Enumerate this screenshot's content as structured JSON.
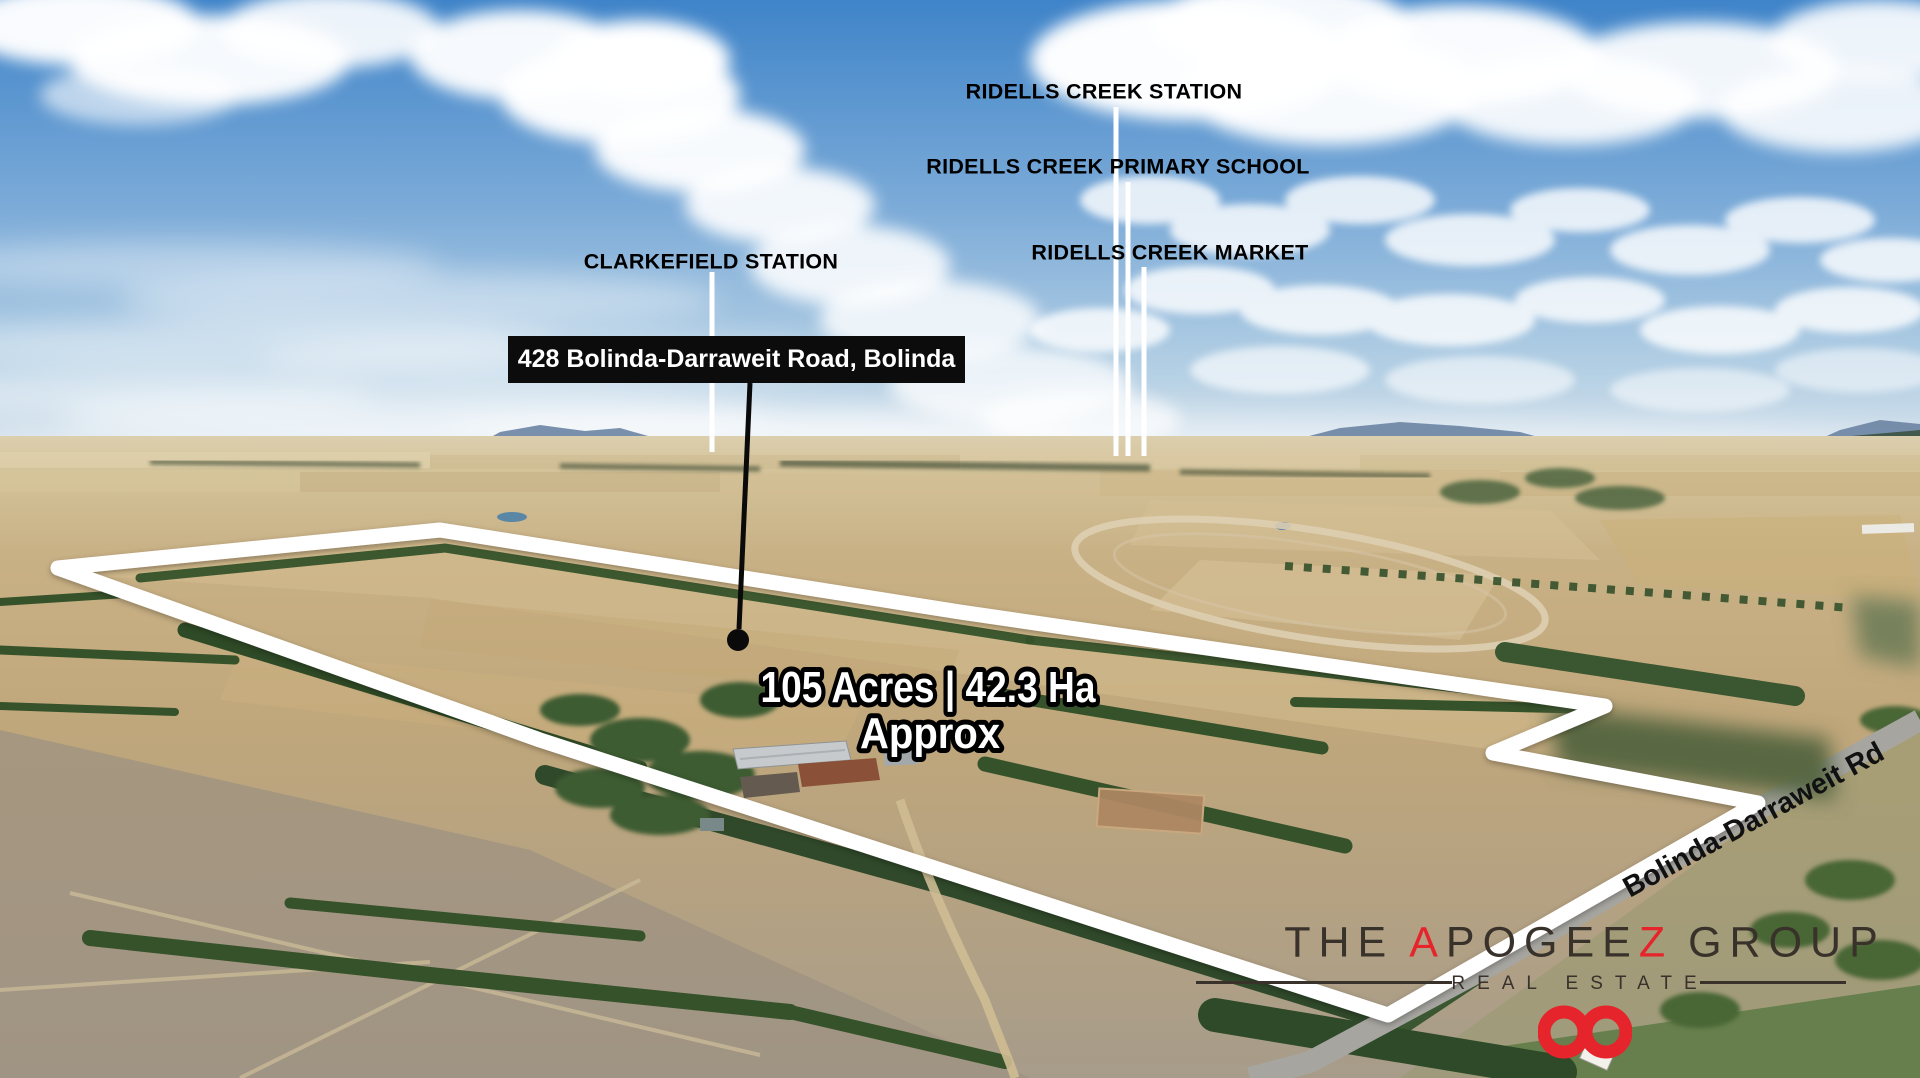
{
  "landmarks": {
    "station": "RIDELLS CREEK STATION",
    "school": "RIDELLS CREEK PRIMARY SCHOOL",
    "market": "RIDELLS CREEK MARKET",
    "clarkefield": "CLARKEFIELD STATION"
  },
  "property": {
    "address": "428 Bolinda-Darraweit Road, Bolinda",
    "area": "105 Acres | 42.3 Ha",
    "area_qualifier": "Approx"
  },
  "road_label": "Bolinda-Darraweit Rd",
  "logo": {
    "word1": "THE",
    "brand_a": "A",
    "brand_mid": "POGEE",
    "brand_z": "Z",
    "word3": "GROUP",
    "tagline": "REAL ESTATE",
    "accent_red": "#e6242b",
    "text_color": "#38322b"
  },
  "colors": {
    "boundary_outline": "#ffffff",
    "label_text": "#000000",
    "address_bg": "#0c0c0c",
    "address_text": "#ffffff"
  }
}
